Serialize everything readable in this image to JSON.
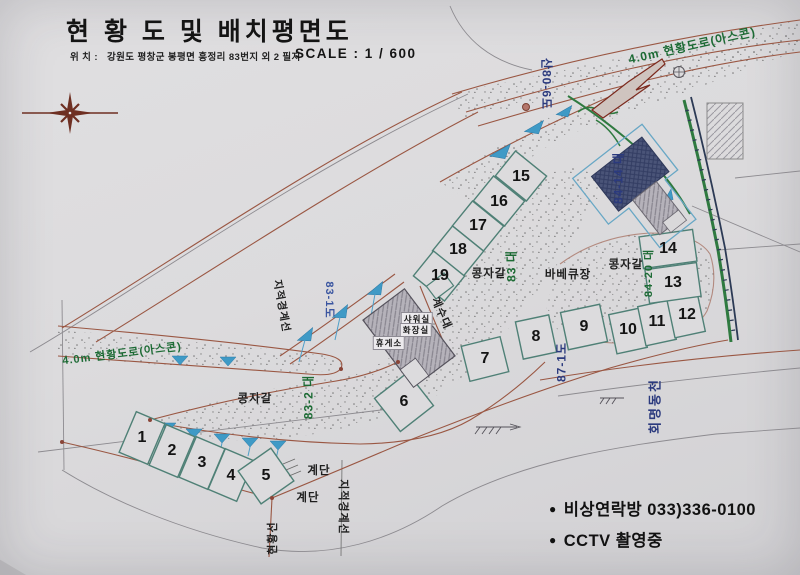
{
  "header": {
    "title": "현 황 도 및  배치평면도",
    "location_label": "위  치 :",
    "location_value": "강원도 평창군 봉평면 흥정리 83번지 외 2 필지",
    "scale": "SCALE  :  1 / 600"
  },
  "plots": [
    "1",
    "2",
    "3",
    "4",
    "5",
    "6",
    "7",
    "8",
    "9",
    "10",
    "11",
    "12",
    "13",
    "14",
    "15",
    "16",
    "17",
    "18",
    "19"
  ],
  "labels": {
    "road_asphalt": "4.0m 현황도로(아스콘)",
    "san80_6": "산80-6도",
    "lot84_14": "84-14 대",
    "lot84_20": "84-20 대",
    "lot87_1": "87-1도",
    "lot83_1": "83-1도",
    "lot83": "83 대",
    "lot83_2": "83-2 대",
    "gravel": "콩자갈",
    "bbq": "바베큐장",
    "sink": "계수대",
    "shower": "샤워실",
    "toilet": "화장실",
    "rest_area": "휴게소",
    "stairs": "계단",
    "cadastral": "지적경계선",
    "status_line": "현황선",
    "stream": "회명동천"
  },
  "notices": {
    "bullet": "●",
    "emergency": "비상연락방  033)336-0100",
    "cctv": "CCTV 촬영중"
  },
  "colors": {
    "board": "#dcdbdd",
    "line_brown": "#9a5743",
    "line_gray": "#8d8b90",
    "plot_teal": "#4f8076",
    "text_green": "#1d6b35",
    "text_navy": "#2b3a7e",
    "water_blue": "#3f9ac6",
    "building_navy": "#4a5478"
  }
}
